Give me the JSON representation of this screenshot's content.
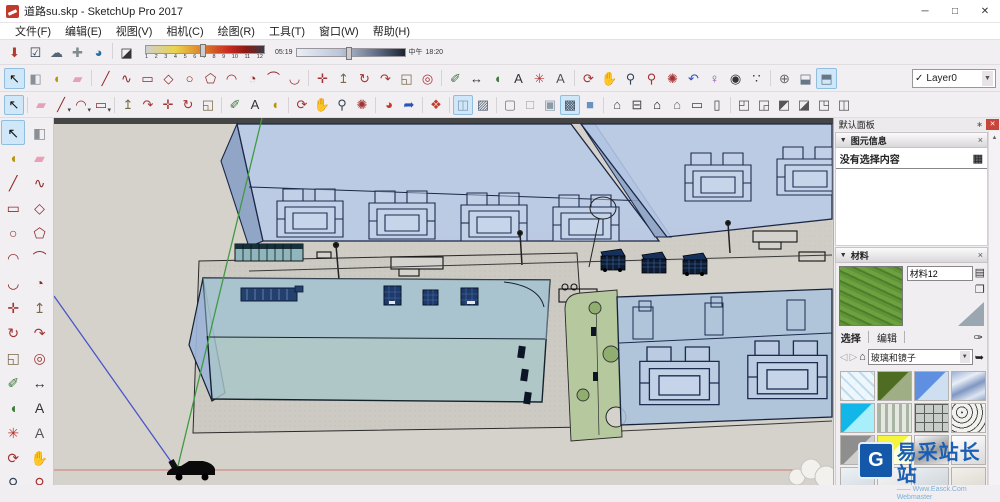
{
  "colors": {
    "toolbar_bg": "#f2eff2",
    "viewport_bg": "#d5d2cc",
    "glass_blue": "#b7c9e6",
    "glass_teal": "#a9c6c9",
    "edge_navy": "#1a2746",
    "lawn_green": "#b6c89e",
    "axis_red": "#cc7a72",
    "axis_green": "#3f9b41",
    "axis_blue": "#4b55c8",
    "highlight": "#cfe7f8",
    "watermark_blue": "#1a5fb4"
  },
  "window": {
    "title": "道路su.skp - SketchUp Pro 2017",
    "minimize": "─",
    "maximize": "□",
    "close": "✕"
  },
  "menubar": {
    "items": [
      "文件(F)",
      "编辑(E)",
      "视图(V)",
      "相机(C)",
      "绘图(R)",
      "工具(T)",
      "窗口(W)",
      "帮助(H)"
    ]
  },
  "toolbar_top": {
    "icons": [
      {
        "name": "share-model-icon",
        "glyph": "⬇",
        "color": "#b03a2e"
      },
      {
        "name": "model-checkbox-icon",
        "glyph": "☑",
        "color": "#2c3e50"
      },
      {
        "name": "upload-cloud-icon",
        "glyph": "☁",
        "color": "#566573"
      },
      {
        "name": "add-link-icon",
        "glyph": "✚",
        "color": "#7f8c8d"
      },
      {
        "name": "extension-warehouse-icon",
        "glyph": "◕",
        "color": "#2471a3"
      },
      {
        "cls": "sep"
      },
      {
        "name": "shadow-dialog-icon",
        "glyph": "◪",
        "color": "#333333"
      }
    ],
    "shadow": {
      "months": [
        "1",
        "2",
        "3",
        "4",
        "5",
        "6",
        "7",
        "8",
        "9",
        "10",
        "11",
        "12"
      ],
      "time_start": "05:19",
      "time_mid": "中午",
      "time_end": "18:20"
    }
  },
  "toolbar_main": {
    "icons": [
      {
        "name": "select-icon",
        "glyph": "↖",
        "color": "#111111",
        "cls": "hl"
      },
      {
        "name": "make-component-icon",
        "glyph": "◧",
        "color": "#8a8f98"
      },
      {
        "name": "paint-bucket-icon",
        "glyph": "◖",
        "color": "#b7950b"
      },
      {
        "name": "eraser-icon",
        "glyph": "▰",
        "color": "#e8a0b4"
      },
      {
        "cls": "sep"
      },
      {
        "name": "line-tool-icon",
        "glyph": "╱",
        "color": "#8e2b2b"
      },
      {
        "name": "freehand-icon",
        "glyph": "∿",
        "color": "#8e2b2b"
      },
      {
        "name": "rectangle-icon",
        "glyph": "▭",
        "color": "#8e2b2b"
      },
      {
        "name": "rotated-rectangle-icon",
        "glyph": "◇",
        "color": "#8e2b2b"
      },
      {
        "name": "circle-icon",
        "glyph": "○",
        "color": "#8e2b2b"
      },
      {
        "name": "polygon-icon",
        "glyph": "⬠",
        "color": "#8e2b2b"
      },
      {
        "name": "arc-icon",
        "glyph": "◠",
        "color": "#8e2b2b"
      },
      {
        "name": "pie-icon",
        "glyph": "◔",
        "color": "#8e2b2b"
      },
      {
        "name": "two-point-arc-icon",
        "glyph": "⌒",
        "color": "#8e2b2b"
      },
      {
        "name": "three-point-arc-icon",
        "glyph": "◡",
        "color": "#8e2b2b"
      },
      {
        "cls": "sep"
      },
      {
        "name": "move-icon",
        "glyph": "✛",
        "color": "#a33333"
      },
      {
        "name": "push-pull-icon",
        "glyph": "↥",
        "color": "#7a6a4a"
      },
      {
        "name": "rotate-icon",
        "glyph": "↻",
        "color": "#a33333"
      },
      {
        "name": "follow-me-icon",
        "glyph": "↷",
        "color": "#a33333"
      },
      {
        "name": "scale-icon",
        "glyph": "◱",
        "color": "#7a6a4a"
      },
      {
        "name": "offset-icon",
        "glyph": "◎",
        "color": "#a33333"
      },
      {
        "cls": "sep"
      },
      {
        "name": "tape-measure-icon",
        "glyph": "✐",
        "color": "#3b7a3b"
      },
      {
        "name": "dimension-icon",
        "glyph": "↔",
        "color": "#333333"
      },
      {
        "name": "protractor-icon",
        "glyph": "◖",
        "color": "#3b7a3b"
      },
      {
        "name": "text-icon",
        "glyph": "A",
        "color": "#333333"
      },
      {
        "name": "axes-icon",
        "glyph": "✳",
        "color": "#bb3333"
      },
      {
        "name": "three-d-text-icon",
        "glyph": "A",
        "color": "#555555"
      },
      {
        "cls": "sep"
      },
      {
        "name": "orbit-icon",
        "glyph": "⟳",
        "color": "#a33333"
      },
      {
        "name": "pan-icon",
        "glyph": "✋",
        "color": "#d9a05c"
      },
      {
        "name": "zoom-icon",
        "glyph": "⚲",
        "color": "#334455"
      },
      {
        "name": "zoom-window-icon",
        "glyph": "⚲",
        "color": "#a33333"
      },
      {
        "name": "zoom-extents-icon",
        "glyph": "✺",
        "color": "#a33333"
      },
      {
        "name": "zoom-previous-icon",
        "glyph": "↶",
        "color": "#2a52be"
      },
      {
        "name": "position-camera-icon",
        "glyph": "♀",
        "color": "#8e44ad"
      },
      {
        "name": "look-around-icon",
        "glyph": "◉",
        "color": "#333333"
      },
      {
        "name": "walk-icon",
        "glyph": "∵",
        "color": "#333333"
      },
      {
        "cls": "sep"
      },
      {
        "name": "section-plane-icon",
        "glyph": "⊕",
        "color": "#666666"
      },
      {
        "name": "section-display-icon",
        "glyph": "⬓",
        "color": "#667788"
      },
      {
        "name": "section-cut-icon",
        "glyph": "⬒",
        "color": "#667788",
        "cls": "hl"
      }
    ],
    "layer_select": {
      "check": "✓",
      "value": "Layer0",
      "caret": "▼"
    }
  },
  "toolbar_third": {
    "icons": [
      {
        "name": "select-icon",
        "glyph": "↖",
        "color": "#111111",
        "cls": "hl"
      },
      {
        "cls": "sep"
      },
      {
        "name": "eraser-icon",
        "glyph": "▰",
        "color": "#e8a0b4"
      },
      {
        "name": "line-tool-icon",
        "glyph": "╱",
        "color": "#8e2b2b",
        "cls": "dd"
      },
      {
        "name": "arc-icon",
        "glyph": "◠",
        "color": "#8e2b2b",
        "cls": "dd"
      },
      {
        "name": "rectangle-icon",
        "glyph": "▭",
        "color": "#8e2b2b",
        "cls": "dd"
      },
      {
        "cls": "sep"
      },
      {
        "name": "push-pull-icon",
        "glyph": "↥",
        "color": "#7a6a4a"
      },
      {
        "name": "follow-me-icon",
        "glyph": "↷",
        "color": "#a33333"
      },
      {
        "name": "move-icon",
        "glyph": "✛",
        "color": "#a33333"
      },
      {
        "name": "rotate-icon",
        "glyph": "↻",
        "color": "#a33333"
      },
      {
        "name": "scale-icon",
        "glyph": "◱",
        "color": "#7a6a4a"
      },
      {
        "cls": "sep"
      },
      {
        "name": "tape-measure-icon",
        "glyph": "✐",
        "color": "#3b7a3b"
      },
      {
        "name": "text-icon",
        "glyph": "A",
        "color": "#333333"
      },
      {
        "name": "paint-bucket-icon",
        "glyph": "◖",
        "color": "#b7950b"
      },
      {
        "cls": "sep"
      },
      {
        "name": "orbit-icon",
        "glyph": "⟳",
        "color": "#a33333"
      },
      {
        "name": "pan-icon",
        "glyph": "✋",
        "color": "#d9a05c"
      },
      {
        "name": "zoom-icon",
        "glyph": "⚲",
        "color": "#334455"
      },
      {
        "name": "zoom-extents-icon",
        "glyph": "✺",
        "color": "#a33333"
      },
      {
        "cls": "sep"
      },
      {
        "name": "get-models-icon",
        "glyph": "◕",
        "color": "#c0392b"
      },
      {
        "name": "export-model-icon",
        "glyph": "➦",
        "color": "#2a52be"
      },
      {
        "cls": "sep"
      },
      {
        "name": "purge-model-icon",
        "glyph": "❖",
        "color": "#c0392b"
      },
      {
        "cls": "sep"
      },
      {
        "name": "xray-mode-icon",
        "glyph": "◫",
        "color": "#7f9bb5",
        "cls": "hl"
      },
      {
        "name": "back-edges-icon",
        "glyph": "▨",
        "color": "#556677"
      },
      {
        "cls": "sep"
      },
      {
        "name": "wireframe-icon",
        "glyph": "▢",
        "color": "#777777"
      },
      {
        "name": "hidden-line-icon",
        "glyph": "□",
        "color": "#999999"
      },
      {
        "name": "shaded-icon",
        "glyph": "▣",
        "color": "#8a9aa8"
      },
      {
        "name": "shaded-textures-icon",
        "glyph": "▩",
        "color": "#445566",
        "cls": "hl"
      },
      {
        "name": "monochrome-icon",
        "glyph": "■",
        "color": "#6a92c0"
      },
      {
        "cls": "sep"
      },
      {
        "name": "view-iso-icon",
        "glyph": "⌂",
        "color": "#444444"
      },
      {
        "name": "view-top-icon",
        "glyph": "⊟",
        "color": "#444444"
      },
      {
        "name": "view-front-icon",
        "glyph": "⌂",
        "color": "#111111"
      },
      {
        "name": "view-back-icon",
        "glyph": "⌂",
        "color": "#666666"
      },
      {
        "name": "view-left-icon",
        "glyph": "▭",
        "color": "#444444"
      },
      {
        "name": "view-right-icon",
        "glyph": "▯",
        "color": "#444444"
      },
      {
        "cls": "sep"
      },
      {
        "name": "solid-outer-shell-icon",
        "glyph": "◰",
        "color": "#555555"
      },
      {
        "name": "solid-intersect-icon",
        "glyph": "◲",
        "color": "#555555"
      },
      {
        "name": "solid-union-icon",
        "glyph": "◩",
        "color": "#555555"
      },
      {
        "name": "solid-subtract-icon",
        "glyph": "◪",
        "color": "#555555"
      },
      {
        "name": "solid-trim-icon",
        "glyph": "◳",
        "color": "#555555"
      },
      {
        "name": "solid-split-icon",
        "glyph": "◫",
        "color": "#555555"
      }
    ]
  },
  "palette": {
    "icons": [
      {
        "name": "select-icon",
        "glyph": "↖",
        "color": "#111111",
        "cls": "hl"
      },
      {
        "name": "make-component-icon",
        "glyph": "◧",
        "color": "#8a8f98"
      },
      {
        "name": "paint-bucket-icon",
        "glyph": "◖",
        "color": "#b7950b"
      },
      {
        "name": "eraser-icon",
        "glyph": "▰",
        "color": "#e8a0b4"
      },
      {
        "name": "line-tool-icon",
        "glyph": "╱",
        "color": "#8e2b2b"
      },
      {
        "name": "freehand-icon",
        "glyph": "∿",
        "color": "#8e2b2b"
      },
      {
        "name": "rectangle-icon",
        "glyph": "▭",
        "color": "#8e2b2b"
      },
      {
        "name": "rotated-rectangle-icon",
        "glyph": "◇",
        "color": "#8e2b2b"
      },
      {
        "name": "circle-icon",
        "glyph": "○",
        "color": "#8e2b2b"
      },
      {
        "name": "polygon-icon",
        "glyph": "⬠",
        "color": "#8e2b2b"
      },
      {
        "name": "arc-icon",
        "glyph": "◠",
        "color": "#8e2b2b"
      },
      {
        "name": "two-point-arc-icon",
        "glyph": "⌒",
        "color": "#8e2b2b"
      },
      {
        "name": "three-point-arc-icon",
        "glyph": "◡",
        "color": "#8e2b2b"
      },
      {
        "name": "pie-icon",
        "glyph": "◔",
        "color": "#8e2b2b"
      },
      {
        "name": "move-icon",
        "glyph": "✛",
        "color": "#a33333"
      },
      {
        "name": "push-pull-icon",
        "glyph": "↥",
        "color": "#7a6a4a"
      },
      {
        "name": "rotate-icon",
        "glyph": "↻",
        "color": "#a33333"
      },
      {
        "name": "follow-me-icon",
        "glyph": "↷",
        "color": "#a33333"
      },
      {
        "name": "scale-icon",
        "glyph": "◱",
        "color": "#7a6a4a"
      },
      {
        "name": "offset-icon",
        "glyph": "◎",
        "color": "#a33333"
      },
      {
        "name": "tape-measure-icon",
        "glyph": "✐",
        "color": "#3b7a3b"
      },
      {
        "name": "dimension-icon",
        "glyph": "↔",
        "color": "#333333"
      },
      {
        "name": "protractor-icon",
        "glyph": "◖",
        "color": "#3b7a3b"
      },
      {
        "name": "text-icon",
        "glyph": "A",
        "color": "#333333"
      },
      {
        "name": "axes-icon",
        "glyph": "✳",
        "color": "#bb3333"
      },
      {
        "name": "three-d-text-icon",
        "glyph": "A",
        "color": "#555555"
      },
      {
        "name": "orbit-icon",
        "glyph": "⟳",
        "color": "#a33333"
      },
      {
        "name": "pan-icon",
        "glyph": "✋",
        "color": "#d9a05c"
      },
      {
        "name": "zoom-icon",
        "glyph": "⚲",
        "color": "#334455"
      },
      {
        "name": "zoom-window-icon",
        "glyph": "⚲",
        "color": "#a33333"
      },
      {
        "name": "zoom-extents-icon",
        "glyph": "✺",
        "color": "#a33333"
      },
      {
        "name": "zoom-previous-icon",
        "glyph": "↶",
        "color": "#2a52be"
      }
    ]
  },
  "panel": {
    "title": "默认面板",
    "pin_glyph": "∗",
    "close_glyph": "✕",
    "scroll_up_glyph": "▲",
    "entity": {
      "collapse_glyph": "▼",
      "header": "图元信息",
      "close_glyph": "×",
      "empty_text": "没有选择内容",
      "detail_glyph": "▦"
    },
    "materials": {
      "collapse_glyph": "▼",
      "header": "材料",
      "close_glyph": "×",
      "name_value": "材料12",
      "secondary_pane_glyph": "▤",
      "create_glyph": "❐",
      "tabs": [
        {
          "label": "选择",
          "cls": "active"
        },
        {
          "label": "编辑",
          "cls": ""
        }
      ],
      "tab_separator": "│",
      "sample_glyph": "✑",
      "back_glyph": "◁",
      "forward_glyph": "▷",
      "home_glyph": "⌂",
      "category_value": "玻璃和镜子",
      "caret": "▼",
      "detail_glyph": "➥",
      "swatches": [
        {
          "name": "swatch-safety-glass-lattice",
          "bg": "repeating-linear-gradient(45deg,#bfdcef 0 2px,rgba(238,247,252,0.92) 2px 8px),repeating-linear-gradient(-45deg,#bfdcef 0 2px,#eef7fc 2px 8px)"
        },
        {
          "name": "swatch-glass-olive",
          "bg": "linear-gradient(135deg,#4f6d22 49%,#9fae85 51%)"
        },
        {
          "name": "swatch-glass-blue",
          "bg": "linear-gradient(135deg,#5f8fe0 49%,#cfdff2 51%)"
        },
        {
          "name": "swatch-glass-sky-reflective",
          "bg": "linear-gradient(155deg,#9db1d6 0%,#e9eef6 30%,#8097c2 55%,#dde5f1 80%,#93a8cd 100%)"
        },
        {
          "name": "swatch-glass-cyan",
          "bg": "linear-gradient(135deg,#12b6e8 49%,#a8eefb 51%)"
        },
        {
          "name": "swatch-glass-striped",
          "bg": "repeating-linear-gradient(90deg,#aab4a4 0 3px,#e4e8e0 3px 7px)"
        },
        {
          "name": "swatch-glass-blocks",
          "bg": "repeating-linear-gradient(0deg,#5a5f5a 0 1px,rgba(0,0,0,0) 1px 9px),repeating-linear-gradient(90deg,#5a5f5a 0 1px,#c8ccc8 1px 9px)"
        },
        {
          "name": "swatch-glass-speckle",
          "bg": "repeating-radial-gradient(circle at 30% 30%,#4a4a4a 0 1px,#f1f1ee 1px 5px)"
        },
        {
          "name": "swatch-glass-gray",
          "bg": "linear-gradient(135deg,#8e8e8e 49%,#cfcfcd 51%)"
        },
        {
          "name": "swatch-glass-yellow",
          "bg": "linear-gradient(135deg,#f4f43c 49%,#ffffd9 51%)"
        },
        {
          "name": "swatch-mirror-silver",
          "bg": "linear-gradient(160deg,#fafafa,#9a9a9a 55%,#e8e8e8)"
        },
        {
          "name": "swatch-mirror-white",
          "bg": "linear-gradient(160deg,#ffffff,#d9d9d9)"
        },
        {
          "name": "swatch-partial-1",
          "bg": "linear-gradient(160deg,#eef2f6,#cdd5dd)"
        },
        {
          "name": "swatch-partial-2",
          "bg": "linear-gradient(160deg,#f7f7f7,#dedede)"
        },
        {
          "name": "swatch-partial-3",
          "bg": "linear-gradient(160deg,#e8ecf0,#c9cfd6)"
        },
        {
          "name": "swatch-partial-4",
          "bg": "linear-gradient(160deg,#f2f0ea,#d8d5cc)"
        }
      ],
      "preview_bg": "repeating-linear-gradient(25deg,#5f9337 0 3px,#4d7f2a 3px 5px,#6da03f 5px 9px)"
    }
  },
  "watermark": {
    "logo_glyph": "G",
    "brand": "易采站长站",
    "sub": "—— Www.Easck.Com Webmaster"
  }
}
